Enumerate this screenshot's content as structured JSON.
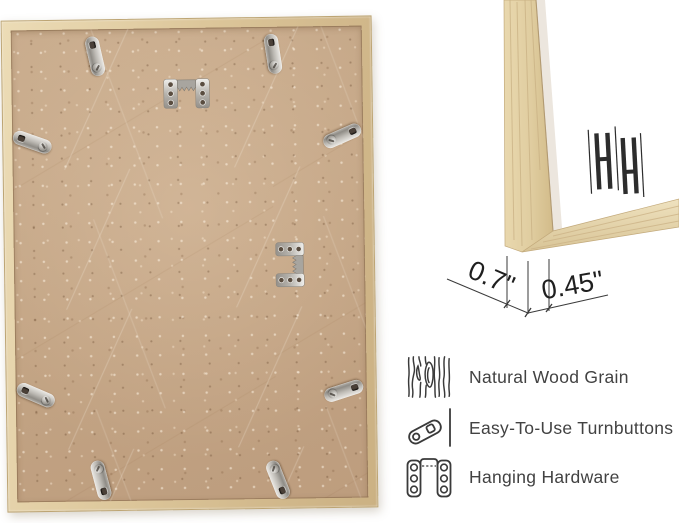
{
  "product_view": {
    "left_panel": {
      "description_name": "frame-back-view",
      "hardware": {
        "turnbutton_count": 8,
        "sawtooth_hanger_count": 2
      }
    },
    "closeup": {
      "brand_logo_text": "HH",
      "dimensions": {
        "depth": "0.7\"",
        "face_width": "0.45\""
      }
    },
    "features": [
      {
        "icon": "wood-grain-icon",
        "label": "Natural Wood Grain"
      },
      {
        "icon": "turnbutton-icon",
        "label": "Easy-To-Use Turnbuttons"
      },
      {
        "icon": "hanging-hardware-icon",
        "label": "Hanging Hardware"
      }
    ],
    "colors": {
      "wood_light": "#ecdcb6",
      "wood_mid": "#d9c297",
      "mdf_back": "#c5a787",
      "metal": "#bcb9b3",
      "annotation_line": "#3a3a3a",
      "text": "#424242",
      "background": "#ffffff"
    }
  }
}
